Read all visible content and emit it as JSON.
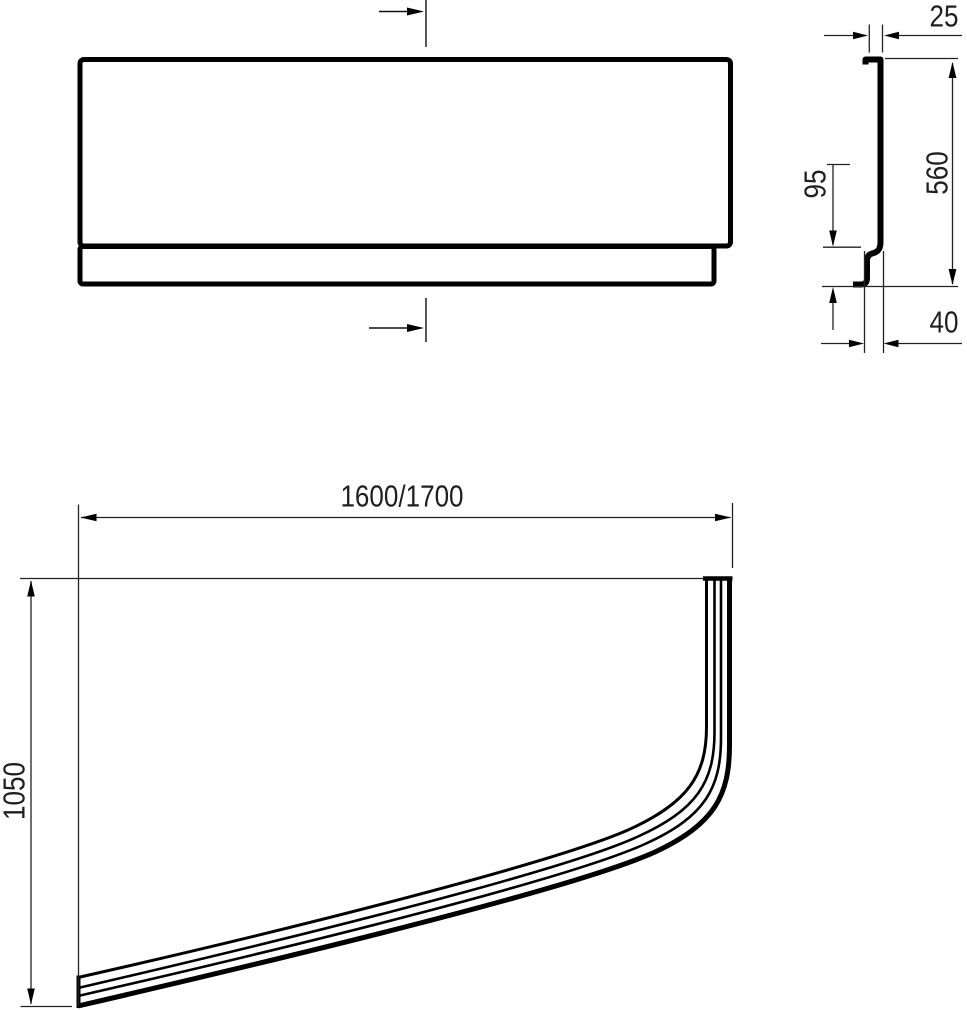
{
  "drawing": {
    "type": "technical-drawing-three-views",
    "background_color": "#ffffff",
    "line_color": "#000000",
    "text_color": "#1f1f1f",
    "dimensions": {
      "profile_top_depth": "25",
      "profile_height": "560",
      "profile_step_height": "95",
      "profile_bottom_depth": "40",
      "plan_length": "1600/1700",
      "plan_width": "1050"
    }
  }
}
